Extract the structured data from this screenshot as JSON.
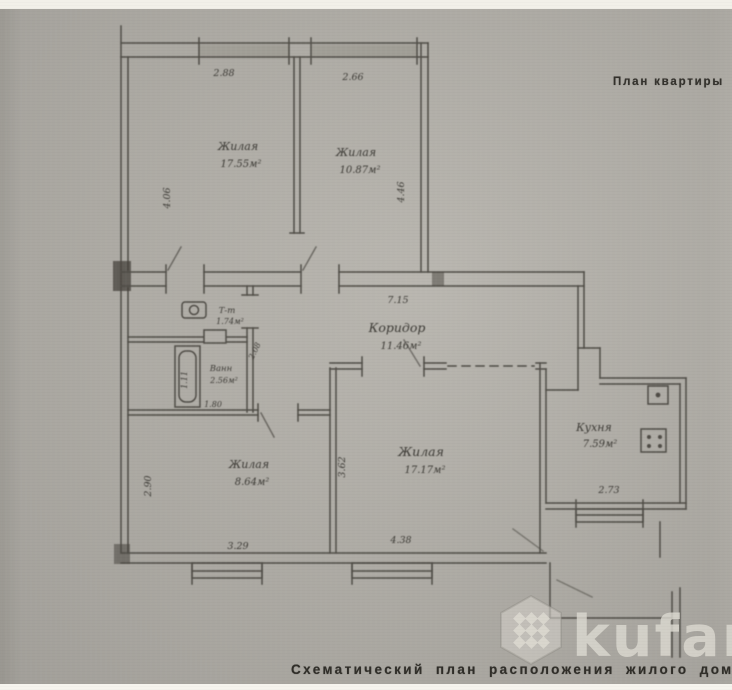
{
  "page": {
    "top_title": "План квартиры",
    "bottom_caption": "Схематический план расположения жилого дома"
  },
  "watermark": {
    "brand": "kufar"
  },
  "plan": {
    "rooms": {
      "living1": {
        "name": "Жилая",
        "area": "17.55м²"
      },
      "living2": {
        "name": "Жилая",
        "area": "10.87м²"
      },
      "corridor": {
        "name": "Коридор",
        "area": "11.46м²"
      },
      "toilet": {
        "name": "Т-т",
        "area": "1.74м²"
      },
      "bath": {
        "name": "Ванн",
        "area": "2.56м²"
      },
      "living3": {
        "name": "Жилая",
        "area": "8.64м²"
      },
      "living4": {
        "name": "Жилая",
        "area": "17.17м²"
      },
      "kitchen": {
        "name": "Кухня",
        "area": "7.59м²"
      }
    },
    "dims": {
      "win1": "2.88",
      "win2": "2.66",
      "living1_height": "4.06",
      "living2_height": "4.46",
      "corridor_length": "7.15",
      "tub_length": "1.11",
      "bath_diag": "2.08",
      "bath_width": "1.80",
      "living3_height": "2.90",
      "living3_width": "3.29",
      "living4_height": "3.62",
      "living4_width": "4.38",
      "kitchen_width": "2.73"
    },
    "fixtures": [
      "toilet",
      "bathtub",
      "sink",
      "stove"
    ],
    "colors": {
      "paper": "#b3b0a9",
      "ink": "#4f4c46",
      "label_ink": "#3c3a35",
      "watermark": "#e2dfd8"
    }
  }
}
